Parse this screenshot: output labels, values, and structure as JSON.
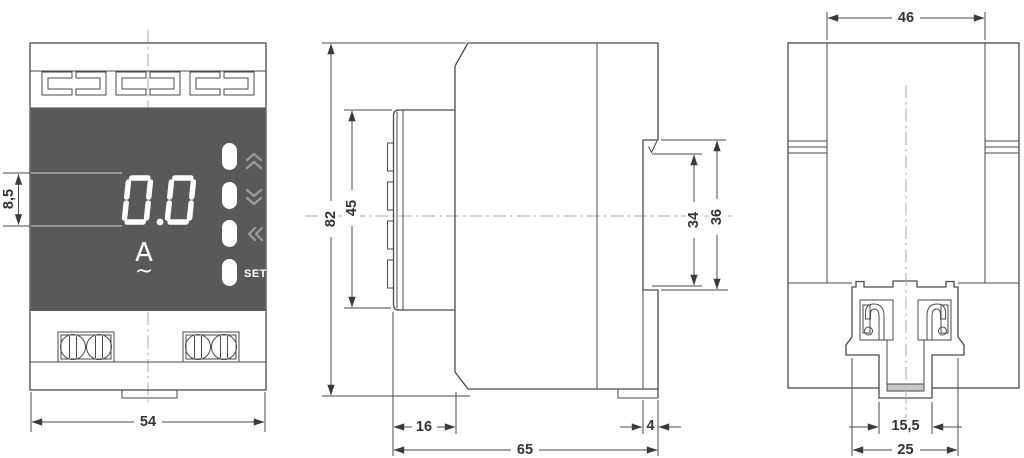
{
  "front": {
    "display": {
      "value": "0.0",
      "unit": "A",
      "ac": "~"
    },
    "buttons": {
      "set": "SET"
    },
    "dims": {
      "display_height": "8,5",
      "width": "54"
    }
  },
  "side": {
    "dims": {
      "overall_height": "82",
      "front_panel_height": "45",
      "recess_inner": "34",
      "recess_outer": "36",
      "front_depth": "16",
      "overall_depth": "65",
      "recess_depth": "4"
    }
  },
  "rear": {
    "dims": {
      "upper_width": "46",
      "clip_slot_width": "15,5",
      "clip_width": "25"
    }
  },
  "colors": {
    "panel": "#59595b",
    "line": "#4a4a4a",
    "centerline": "#a9a9a9",
    "button_glyph": "#9b9b9b",
    "digit": "#ffffff"
  }
}
